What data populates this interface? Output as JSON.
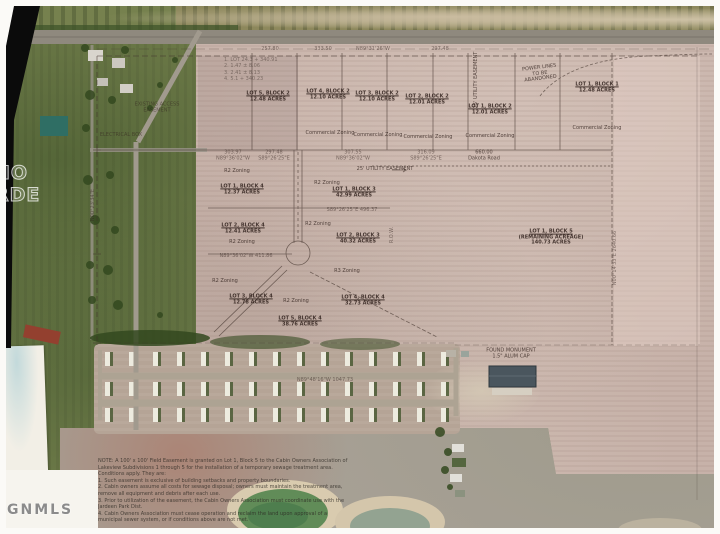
{
  "watermark": {
    "mls": "GNMLS",
    "partial1": "NO",
    "partial2": "RDE"
  },
  "palette": {
    "field": "#c7b2a9",
    "grass": "#76814e",
    "survey_ink": "#42332c",
    "pond": "#618c58",
    "roof": "#4a565e",
    "paper": "#f2efe6"
  },
  "plat": {
    "commercial_zoning": "Commercial Zoning",
    "r2": "R2 Zoning",
    "r3": "R3 Zoning",
    "commercial_lots": [
      {
        "name": "LOT 5, BLOCK 2",
        "acres": "12.48 ACRES"
      },
      {
        "name": "LOT 4, BLOCK 2",
        "acres": "12.10 ACRES"
      },
      {
        "name": "LOT 3, BLOCK 2",
        "acres": "12.10 ACRES"
      },
      {
        "name": "LOT 2, BLOCK 2",
        "acres": "12.01 ACRES"
      },
      {
        "name": "LOT 1, BLOCK 2",
        "acres": "12.01 ACRES"
      },
      {
        "name": "LOT 1, BLOCK 1",
        "acres": "12.48 ACRES"
      }
    ],
    "residential_lots": [
      {
        "name": "LOT 1, BLOCK 4",
        "acres": "12.37 ACRES"
      },
      {
        "name": "LOT 1, BLOCK 3",
        "acres": "42.99 ACRES"
      },
      {
        "name": "LOT 2, BLOCK 4",
        "acres": "12.41 ACRES"
      },
      {
        "name": "LOT 2, BLOCK 3",
        "acres": "40.32 ACRES"
      },
      {
        "name": "LOT 3, BLOCK 4",
        "acres": "12.78 ACRES"
      },
      {
        "name": "LOT 5, BLOCK 4",
        "acres": "38.76 ACRES"
      },
      {
        "name": "LOT 4, BLOCK 4",
        "acres": "32.73 ACRES"
      }
    ],
    "remainder_lot": {
      "name": "LOT 1, BLOCK 5",
      "note": "(REMAINING ACREAGE)",
      "acres": "140.73 ACRES"
    },
    "power_lines": {
      "l1": "POWER LINES",
      "l2": "TO BE",
      "l3": "ABANDONED"
    },
    "utility_easement": "25' UTILITY EASEMENT",
    "found_monument": {
      "l1": "FOUND MONUMENT",
      "l2": "1.5\" ALUM CAP"
    },
    "electrical_box": "ELECTRICAL BOX",
    "access": {
      "l1": "EXISTING ACCESS",
      "l2": "EASEMENT"
    },
    "row_label": "R.O.W.",
    "legend_lines": [
      "1. LOT 24.3 + 340.91",
      "2. 1.47 ± 8.06",
      "3. 2.41 ± 8.13",
      "4. 5.1 + 340.23"
    ],
    "top_distances": [
      "257.80",
      "333.50",
      "N89°31'26\"W",
      "297.48"
    ],
    "bearing_row": [
      {
        "d": "303.97",
        "b": "N89°36'02\"W"
      },
      {
        "d": "297.48",
        "b": "S89°26'25\"E"
      },
      {
        "d": "307.55",
        "b": "N89°36'02\"W"
      },
      {
        "d": "316.09",
        "b": "S89°26'25\"E"
      }
    ],
    "mid_bearings": {
      "b1": "S89°26'25\"E  496.37",
      "b2": "N89°36'02\"W  411.86",
      "b3": "N89°48'16\"W  1047.73"
    },
    "vert_bearing_right": "N00°14'33\"E  2640.66",
    "vert_bearing_left": "N00°23'34\"E",
    "dakota": {
      "dist": "660.00",
      "road": "Dakota Road"
    }
  },
  "notes": {
    "lines": [
      "NOTE: A 100' x 100' Field Easement is granted on Lot 1, Block 5 to the Cabin Owners Association of",
      "Lakeview Subdivisions 1 through 5 for the installation of a temporary sewage treatment area.",
      "Conditions apply. They are:",
      "1. Such easement is exclusive of building setbacks and property boundaries.",
      "2. Cabin owners assume all costs for sewage disposal; owners must maintain the treatment area,",
      "    remove all equipment and debris after each use.",
      "3. Prior to utilization of the easement, the Cabin Owners Association must coordinate use with the",
      "    Jardeen Park Dist.",
      "4. Cabin Owners Association must cease operation and reclaim the land upon approval of a",
      "    municipal sewer system, or if conditions above are not met."
    ]
  }
}
